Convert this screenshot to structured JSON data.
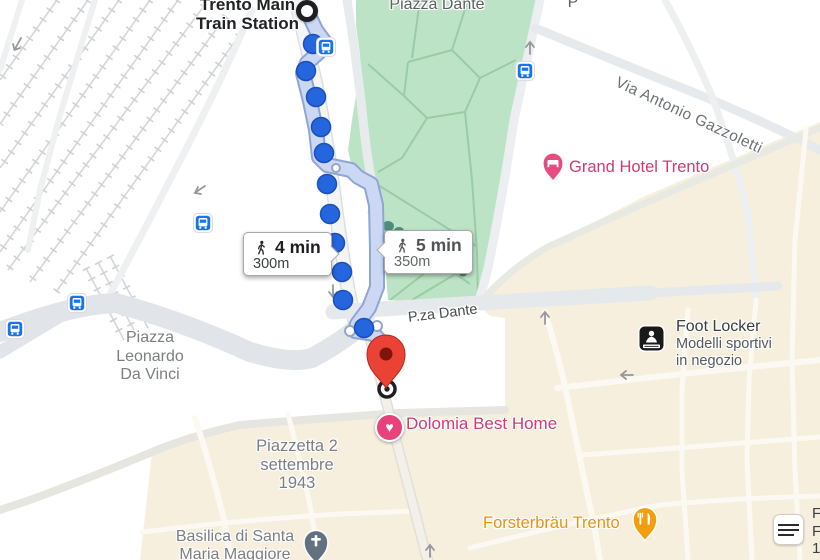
{
  "station": {
    "name_line1": "Trento Main",
    "name_line2": "Train Station"
  },
  "park": {
    "label": "Piazza Dante"
  },
  "streets": {
    "pza_dante": "P.za Dante",
    "via_antonio_gazzoletti": "Via Antonio Gazzoletti",
    "edge_partial_top": "P"
  },
  "areas": {
    "piazza_leonardo_line1": "Piazza",
    "piazza_leonardo_line2": "Leonardo",
    "piazza_leonardo_line3": "Da Vinci",
    "piazzetta_line1": "Piazzetta 2",
    "piazzetta_line2": "settembre",
    "piazzetta_line3": "1943",
    "basilica_line1": "Basilica di Santa",
    "basilica_line2": "Maria Maggiore"
  },
  "pois": {
    "grand_hotel": {
      "name": "Grand Hotel Trento"
    },
    "dolomia": {
      "name": "Dolomia Best Home"
    },
    "foot_locker": {
      "name": "Foot Locker",
      "subtitle_line1": "Modelli sportivi",
      "subtitle_line2": "in negozio"
    },
    "forsterbrau": {
      "name": "Forsterbräu Trento"
    }
  },
  "routes": {
    "selected": {
      "duration": "4 min",
      "distance": "300m"
    },
    "alternative": {
      "duration": "5 min",
      "distance": "350m"
    }
  },
  "icons": {
    "heart": "♥"
  },
  "edge_partial_right": {
    "line1": "F",
    "line2": "F",
    "line3": "1"
  },
  "colors": {
    "park_green": "#bde3c6",
    "city_cream": "#f6efde",
    "route_blue": "#2565dd",
    "ribbon_blue": "#cbd7f3",
    "pin_red": "#ea4335",
    "poi_pink": "#e8427c",
    "poi_orange": "#f29e0f",
    "transit_blue": "#1a73e8"
  }
}
